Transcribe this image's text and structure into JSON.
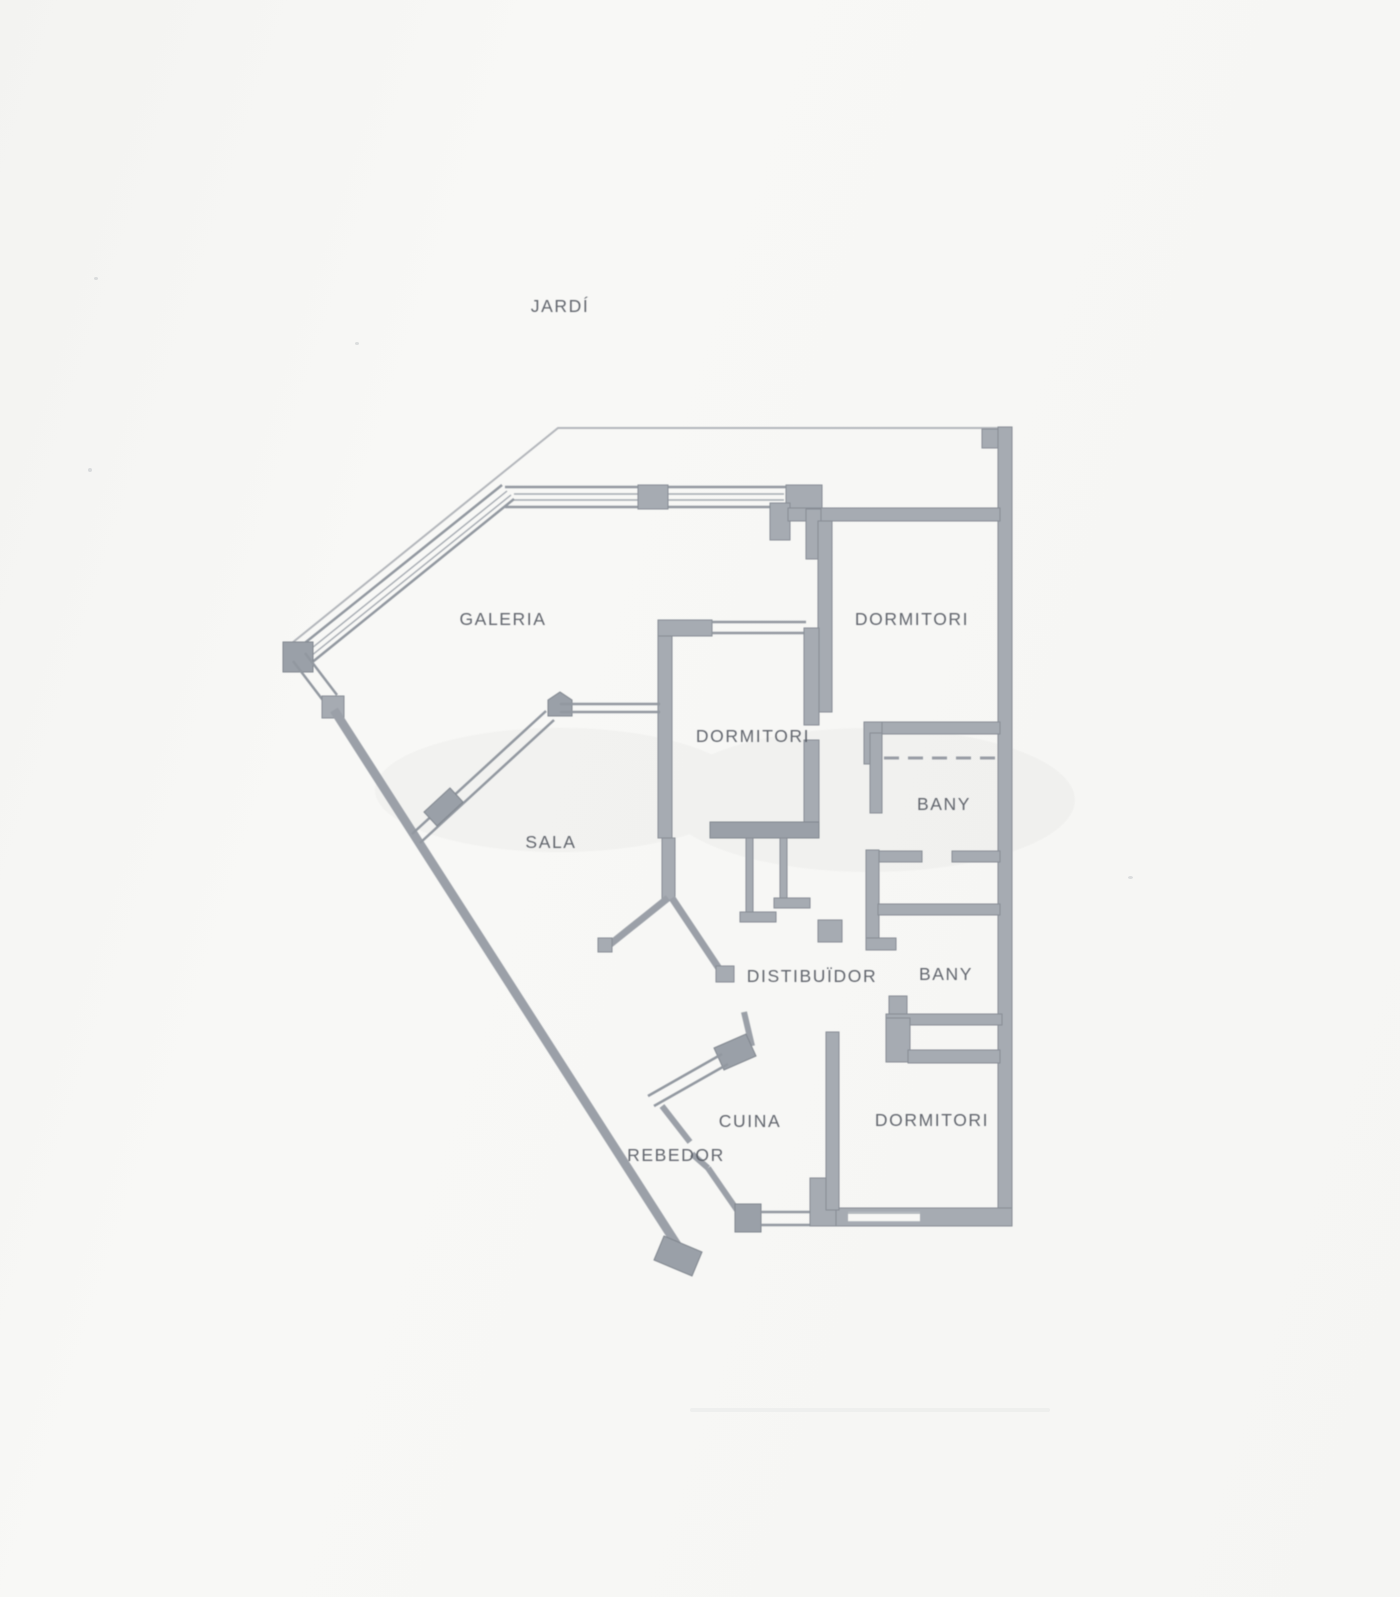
{
  "colors": {
    "paper": "#f7f7f5",
    "wall": "#9ba0a8",
    "wall_block": "#a6abb2",
    "outer_line": "#b3b6bb",
    "label_text": "#4d525b"
  },
  "rooms": {
    "jardi": {
      "label": "JARDÍ"
    },
    "galeria": {
      "label": "GALERIA"
    },
    "dormitori_nord": {
      "label": "DORMITORI"
    },
    "dormitori_centre": {
      "label": "DORMITORI"
    },
    "bany_1": {
      "label": "BANY"
    },
    "sala": {
      "label": "SALA"
    },
    "distribuidor": {
      "label": "DISTIBUÏDOR"
    },
    "bany_2": {
      "label": "BANY"
    },
    "cuina": {
      "label": "CUINA"
    },
    "rebedor": {
      "label": "REBEDOR"
    },
    "dormitori_sud": {
      "label": "DORMITORI"
    }
  }
}
